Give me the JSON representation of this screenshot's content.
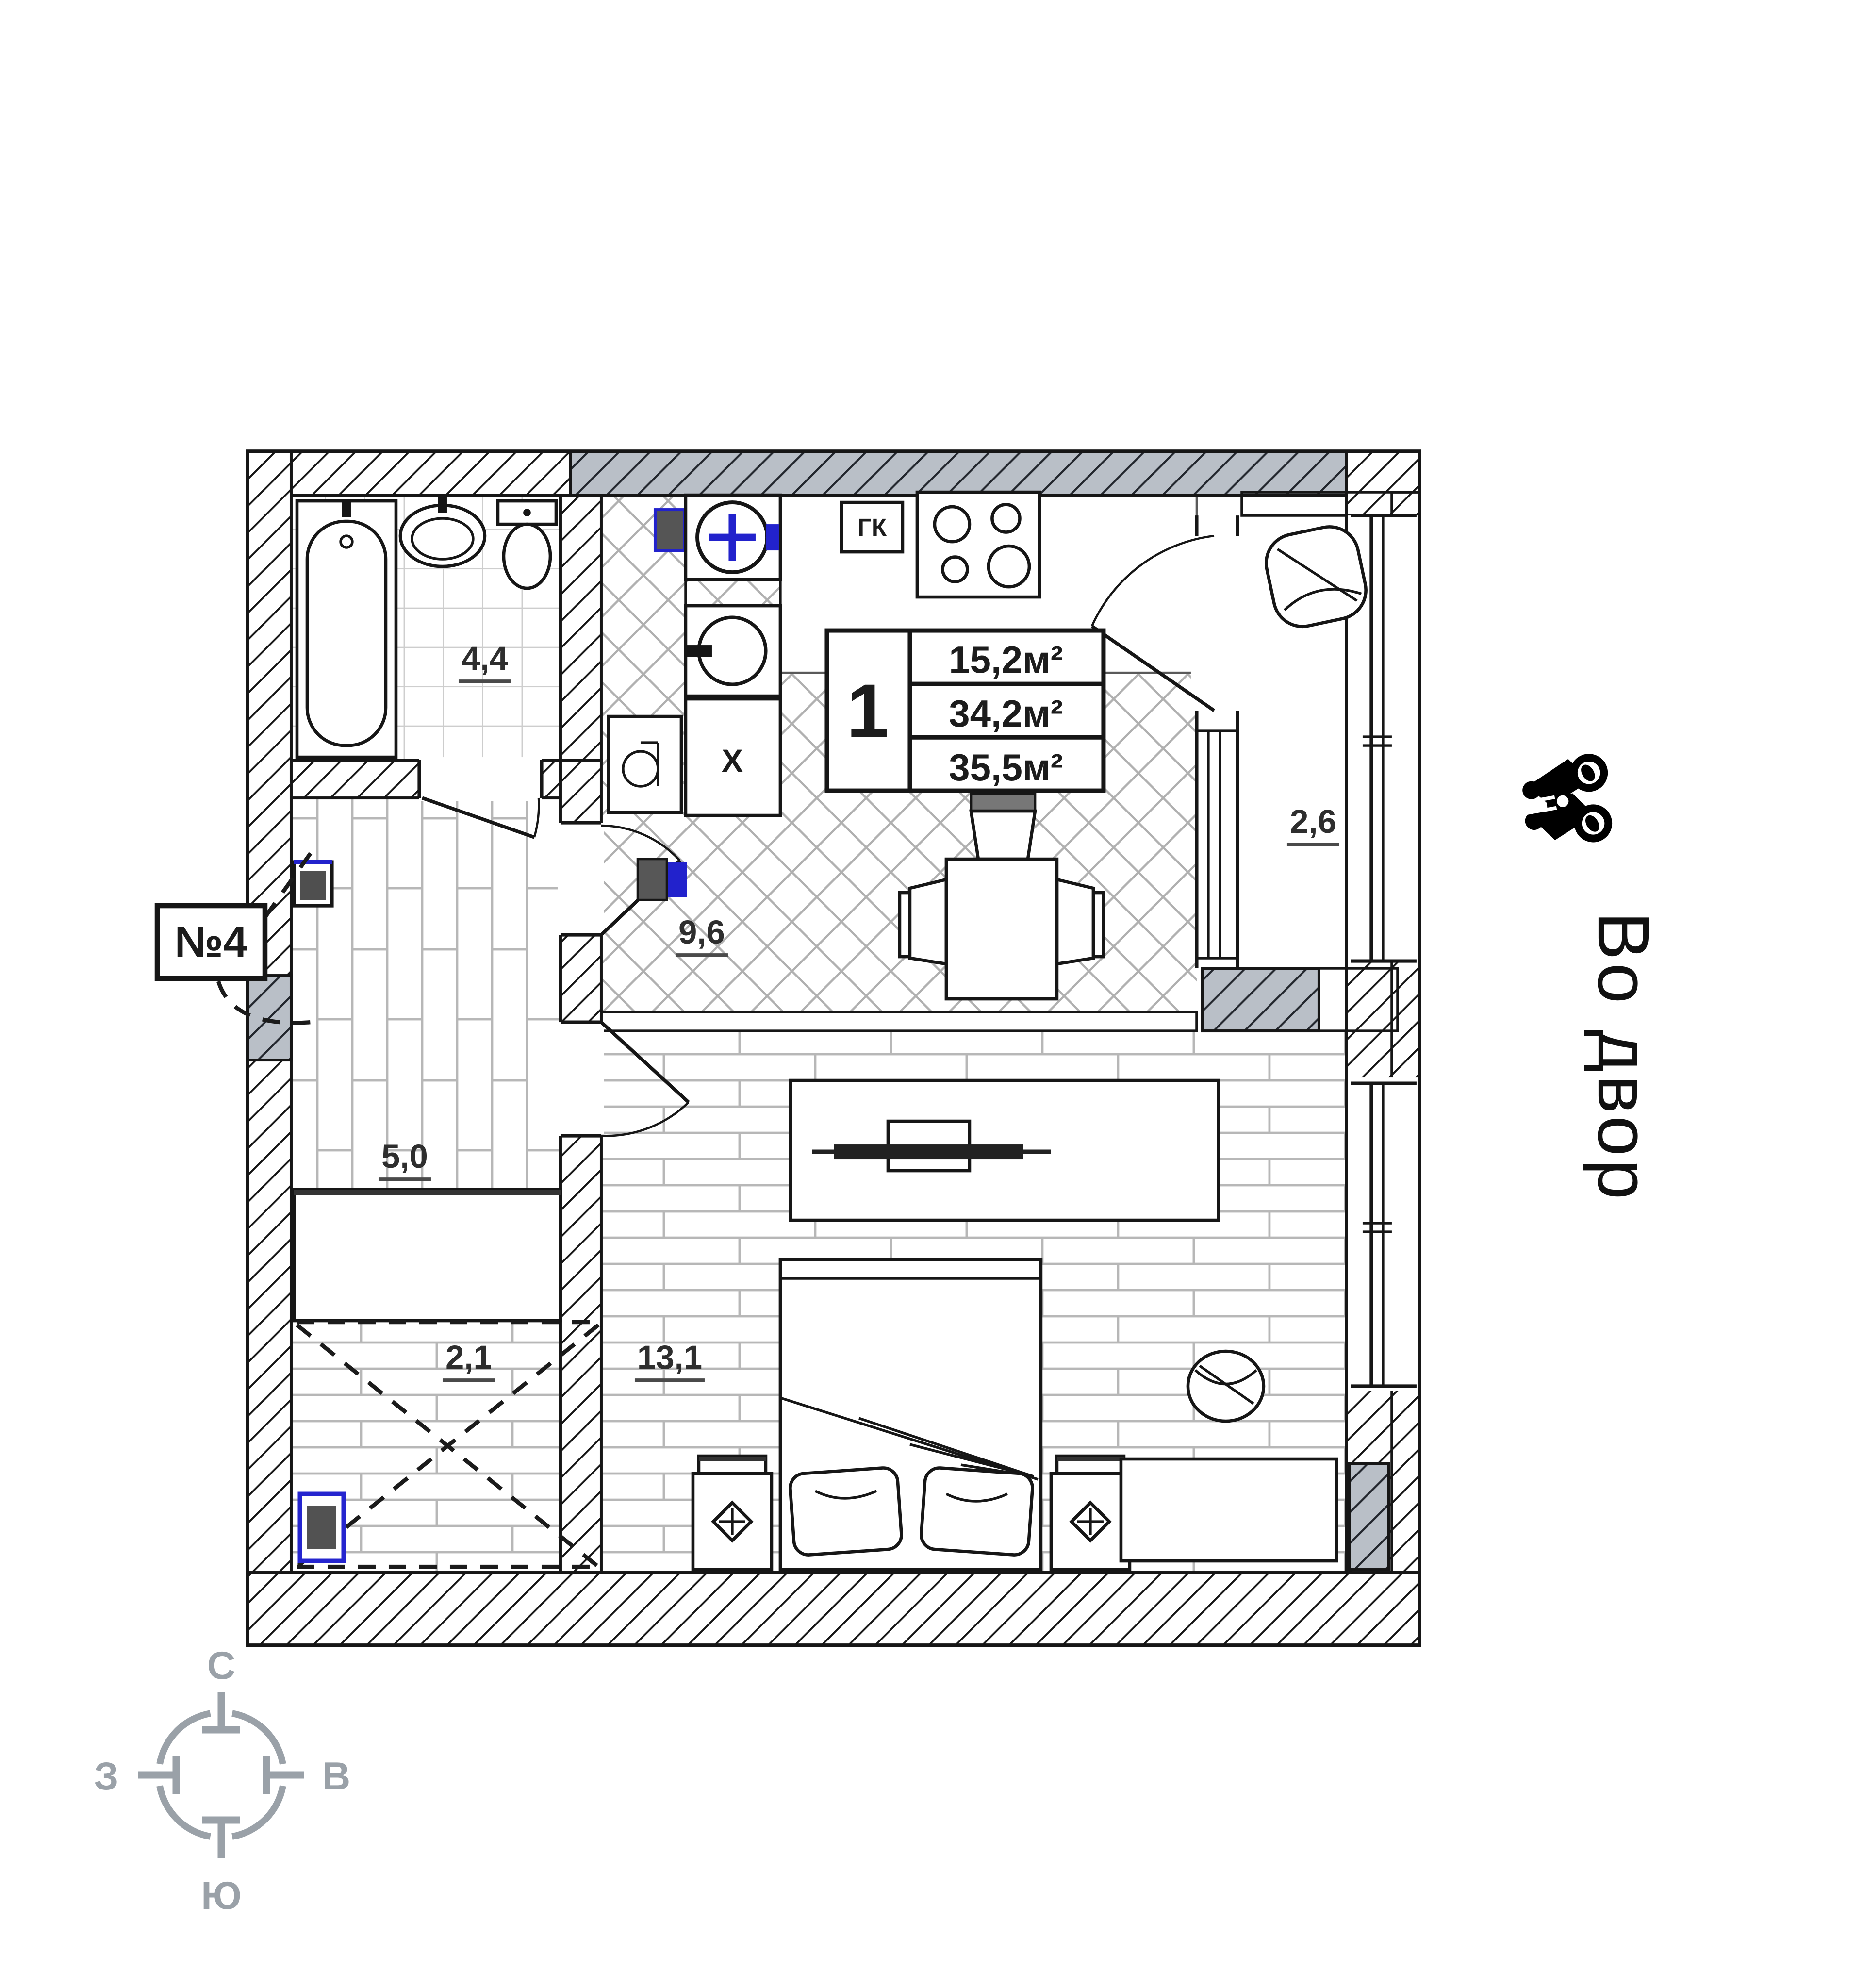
{
  "apartment": {
    "number": "№4",
    "rooms_count": "1",
    "areas": {
      "living": "15,2м²",
      "apartment": "34,2м²",
      "total": "35,5м²"
    }
  },
  "rooms": {
    "bathroom": "4,4",
    "kitchen": "9,6",
    "hallway": "5,0",
    "wardrobe": "2,1",
    "living_room": "13,1",
    "balcony": "2,6"
  },
  "annotations": {
    "gas_cabinet": "ГК",
    "fridge": "X",
    "view_label": "Во двор"
  },
  "compass": {
    "north": "С",
    "east": "В",
    "south": "Ю",
    "west": "З"
  },
  "colors": {
    "wall_gray": "#b9bfc7",
    "accent_blue": "#2222cc",
    "line_dark": "#161616",
    "floor_line": "#b7b7b7",
    "compass_gray": "#9aa1a8"
  }
}
